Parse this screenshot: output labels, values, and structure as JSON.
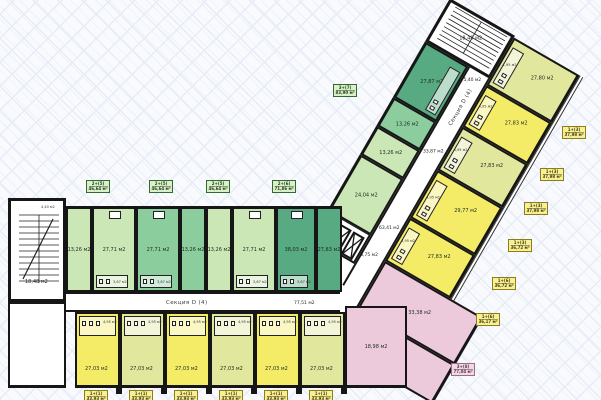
{
  "plan": {
    "section_label": "Секция D (4)",
    "left": {
      "stair_area": "18,48 м2",
      "closet_area": "4,40 м2",
      "corridor_area": "77,51 м2",
      "green_rooms": [
        {
          "area": "13,26 м2",
          "shade": "light"
        },
        {
          "area": "27,71 м2",
          "shade": "light",
          "bath": "3,67 м2"
        },
        {
          "area": "27,71 м2",
          "shade": "medium",
          "bath": "3,67 м2"
        },
        {
          "area": "13,26 м2",
          "shade": "medium"
        },
        {
          "area": "13,26 м2",
          "shade": "light"
        },
        {
          "area": "27,71 м2",
          "shade": "light",
          "bath": "3,67 м2"
        },
        {
          "area": "38,03 м2",
          "shade": "dark",
          "bath": "3,67 м2"
        },
        {
          "area": "27,83 м2",
          "shade": "dark"
        }
      ],
      "studios": [
        {
          "area": "27,03 м2",
          "bath": "4,95 м2",
          "shade": "bright"
        },
        {
          "area": "27,03 м2",
          "bath": "4,95 м2",
          "shade": "pale"
        },
        {
          "area": "27,03 м2",
          "bath": "4,95 м2",
          "shade": "bright"
        },
        {
          "area": "27,03 м2",
          "bath": "4,95 м2",
          "shade": "pale"
        },
        {
          "area": "27,03 м2",
          "bath": "4,95 м2",
          "shade": "bright"
        },
        {
          "area": "27,03 м2",
          "bath": "4,95 м2",
          "shade": "pale"
        }
      ]
    },
    "core": {
      "hall_area": "8,75 м2",
      "corridor_area": "33,87 м2",
      "lobby_area": "63,41 м2"
    },
    "wing": {
      "stair_area": "18,48 м2",
      "entry_area": "5,40 м2",
      "green_rooms": [
        {
          "area": "24,04 м2",
          "shade": "light"
        },
        {
          "area": "13,26 м2",
          "shade": "light"
        },
        {
          "area": "13,26 м2",
          "shade": "medium"
        },
        {
          "area": "27,87 м2",
          "shade": "dark",
          "bath": "3,67 м2"
        }
      ],
      "yellow_rooms": [
        {
          "area": "27,83 м2",
          "shade": "bright",
          "bath": "4,95 м2"
        },
        {
          "area": "29,77 м2",
          "shade": "bright",
          "bath": "4,95 м2"
        },
        {
          "area": "27,83 м2",
          "shade": "pale",
          "bath": "4,95 м2"
        },
        {
          "area": "27,83 м2",
          "shade": "bright",
          "bath": "4,95 м2"
        },
        {
          "area": "27,80 м2",
          "shade": "pale",
          "bath": "1,95 м2"
        }
      ],
      "pink_rooms": [
        {
          "area": "15,64 м2"
        },
        {
          "area": "33,38 м2"
        },
        {
          "area": "18,98 м2"
        }
      ]
    },
    "tags": {
      "green": [
        {
          "type": "2+(5)",
          "area": "46,64 м²"
        },
        {
          "type": "2+(5)",
          "area": "46,64 м²"
        },
        {
          "type": "2+(5)",
          "area": "46,64 м²"
        },
        {
          "type": "2+(6)",
          "area": "71,86 м²"
        },
        {
          "type": "3+(7)",
          "area": "83,90 м²"
        }
      ],
      "yellow_right": [
        {
          "type": "1+(3)",
          "area": "37,98 м²"
        },
        {
          "type": "1+(3)",
          "area": "37,98 м²"
        },
        {
          "type": "1+(3)",
          "area": "37,98 м²"
        },
        {
          "type": "1+(3)",
          "area": "36,72 м²"
        },
        {
          "type": "1+(6)",
          "area": "36,72 м²"
        },
        {
          "type": "1+(6)",
          "area": "36,17 м²"
        }
      ],
      "yellow_bottom": [
        {
          "type": "1+(1)",
          "area": "33,93 м²"
        },
        {
          "type": "1+(1)",
          "area": "33,93 м²"
        },
        {
          "type": "1+(1)",
          "area": "33,93 м²"
        },
        {
          "type": "1+(1)",
          "area": "33,93 м²"
        },
        {
          "type": "1+(1)",
          "area": "33,93 м²"
        },
        {
          "type": "1+(1)",
          "area": "33,93 м²"
        }
      ],
      "pink": {
        "type": "3+(8)",
        "area": "77,04 м²"
      }
    }
  }
}
